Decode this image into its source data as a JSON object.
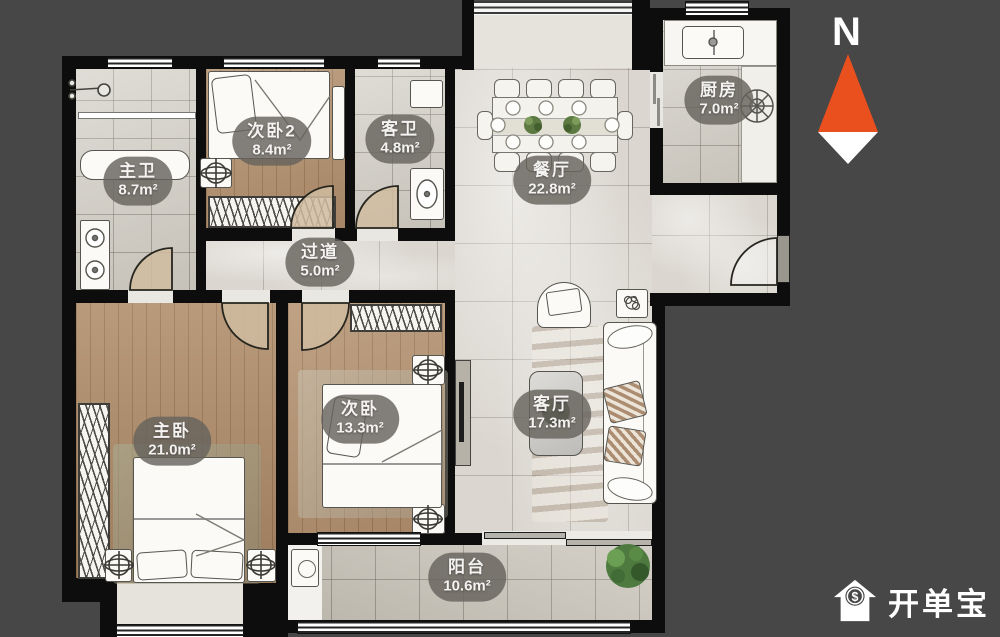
{
  "background": "#474747",
  "wall_color": "#0d0d0d",
  "accent_orange": "#ea4f1e",
  "label_bg": "rgba(102,99,93,0.82)",
  "north": {
    "label": "N"
  },
  "watermark": {
    "text": "开单宝",
    "dollar": "$",
    "icon": "house-dollar-icon"
  },
  "rooms": [
    {
      "id": "master-bath",
      "name": "主卫",
      "area": "8.7m²"
    },
    {
      "id": "bedroom2",
      "name": "次卧2",
      "area": "8.4m²"
    },
    {
      "id": "guest-bath",
      "name": "客卫",
      "area": "4.8m²"
    },
    {
      "id": "dining",
      "name": "餐厅",
      "area": "22.8m²"
    },
    {
      "id": "kitchen",
      "name": "厨房",
      "area": "7.0m²"
    },
    {
      "id": "hallway",
      "name": "过道",
      "area": "5.0m²"
    },
    {
      "id": "master-bedroom",
      "name": "主卧",
      "area": "21.0m²"
    },
    {
      "id": "bedroom",
      "name": "次卧",
      "area": "13.3m²"
    },
    {
      "id": "living",
      "name": "客厅",
      "area": "17.3m²"
    },
    {
      "id": "balcony",
      "name": "阳台",
      "area": "10.6m²"
    }
  ]
}
